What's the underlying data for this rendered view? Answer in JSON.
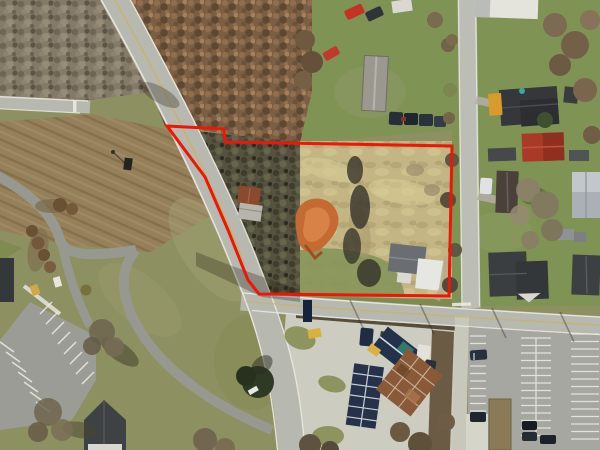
{
  "page": {
    "type": "aerial-photograph",
    "description": "Drone aerial photo of a rural road intersection with a land parcel outlined in red; bare winter trees, houses with dark and red roofs, a gas-station style building, and striped parking lots."
  },
  "boundary": {
    "color": "#ee1607",
    "stroke_width": 3,
    "points_str": "167,126 224,129 225,142 452,146 449,296 259,294 248,280 228,230 205,177"
  },
  "palette": {
    "road": "#b7b8b0",
    "road-edge": "#edebe0",
    "road-minor": "#97988f",
    "concrete": "#cdccc1",
    "asphalt": "#a6a7a1",
    "grass": "#8d9060",
    "lawn": "#7f9355",
    "meadow": "#c3b684",
    "field": "#96805c",
    "field-row": "#85704c",
    "forest-gray": "#847a68",
    "forest-rust": "#7b5f45",
    "forest-dark": "#55523f",
    "dirt-orange": "#c46a32",
    "roof-dark": "#393c3f",
    "roof-red": "#a93a28",
    "roof-rust": "#8a5a38",
    "roof-navy": "#24314a",
    "centerline-yellow": "#c9b35a"
  },
  "features": [
    "red property boundary polygon",
    "main two-lane road curving north-west to south",
    "east-west road",
    "north-south road on right",
    "side street top-left",
    "campus loop drives bottom-left",
    "angled-stall parking lot bottom-left",
    "large striped parking lot bottom-right",
    "gas station / market buildings with rust and navy roofs",
    "white house with gray roof inside parcel",
    "rust-roof shed inside parcel",
    "orange dirt erosion patch inside parcel",
    "mobile home and parked cars top-center",
    "houses with dark, red and gray roofs on east side",
    "plowed brown field west of main road",
    "bare winter forest blocks"
  ]
}
